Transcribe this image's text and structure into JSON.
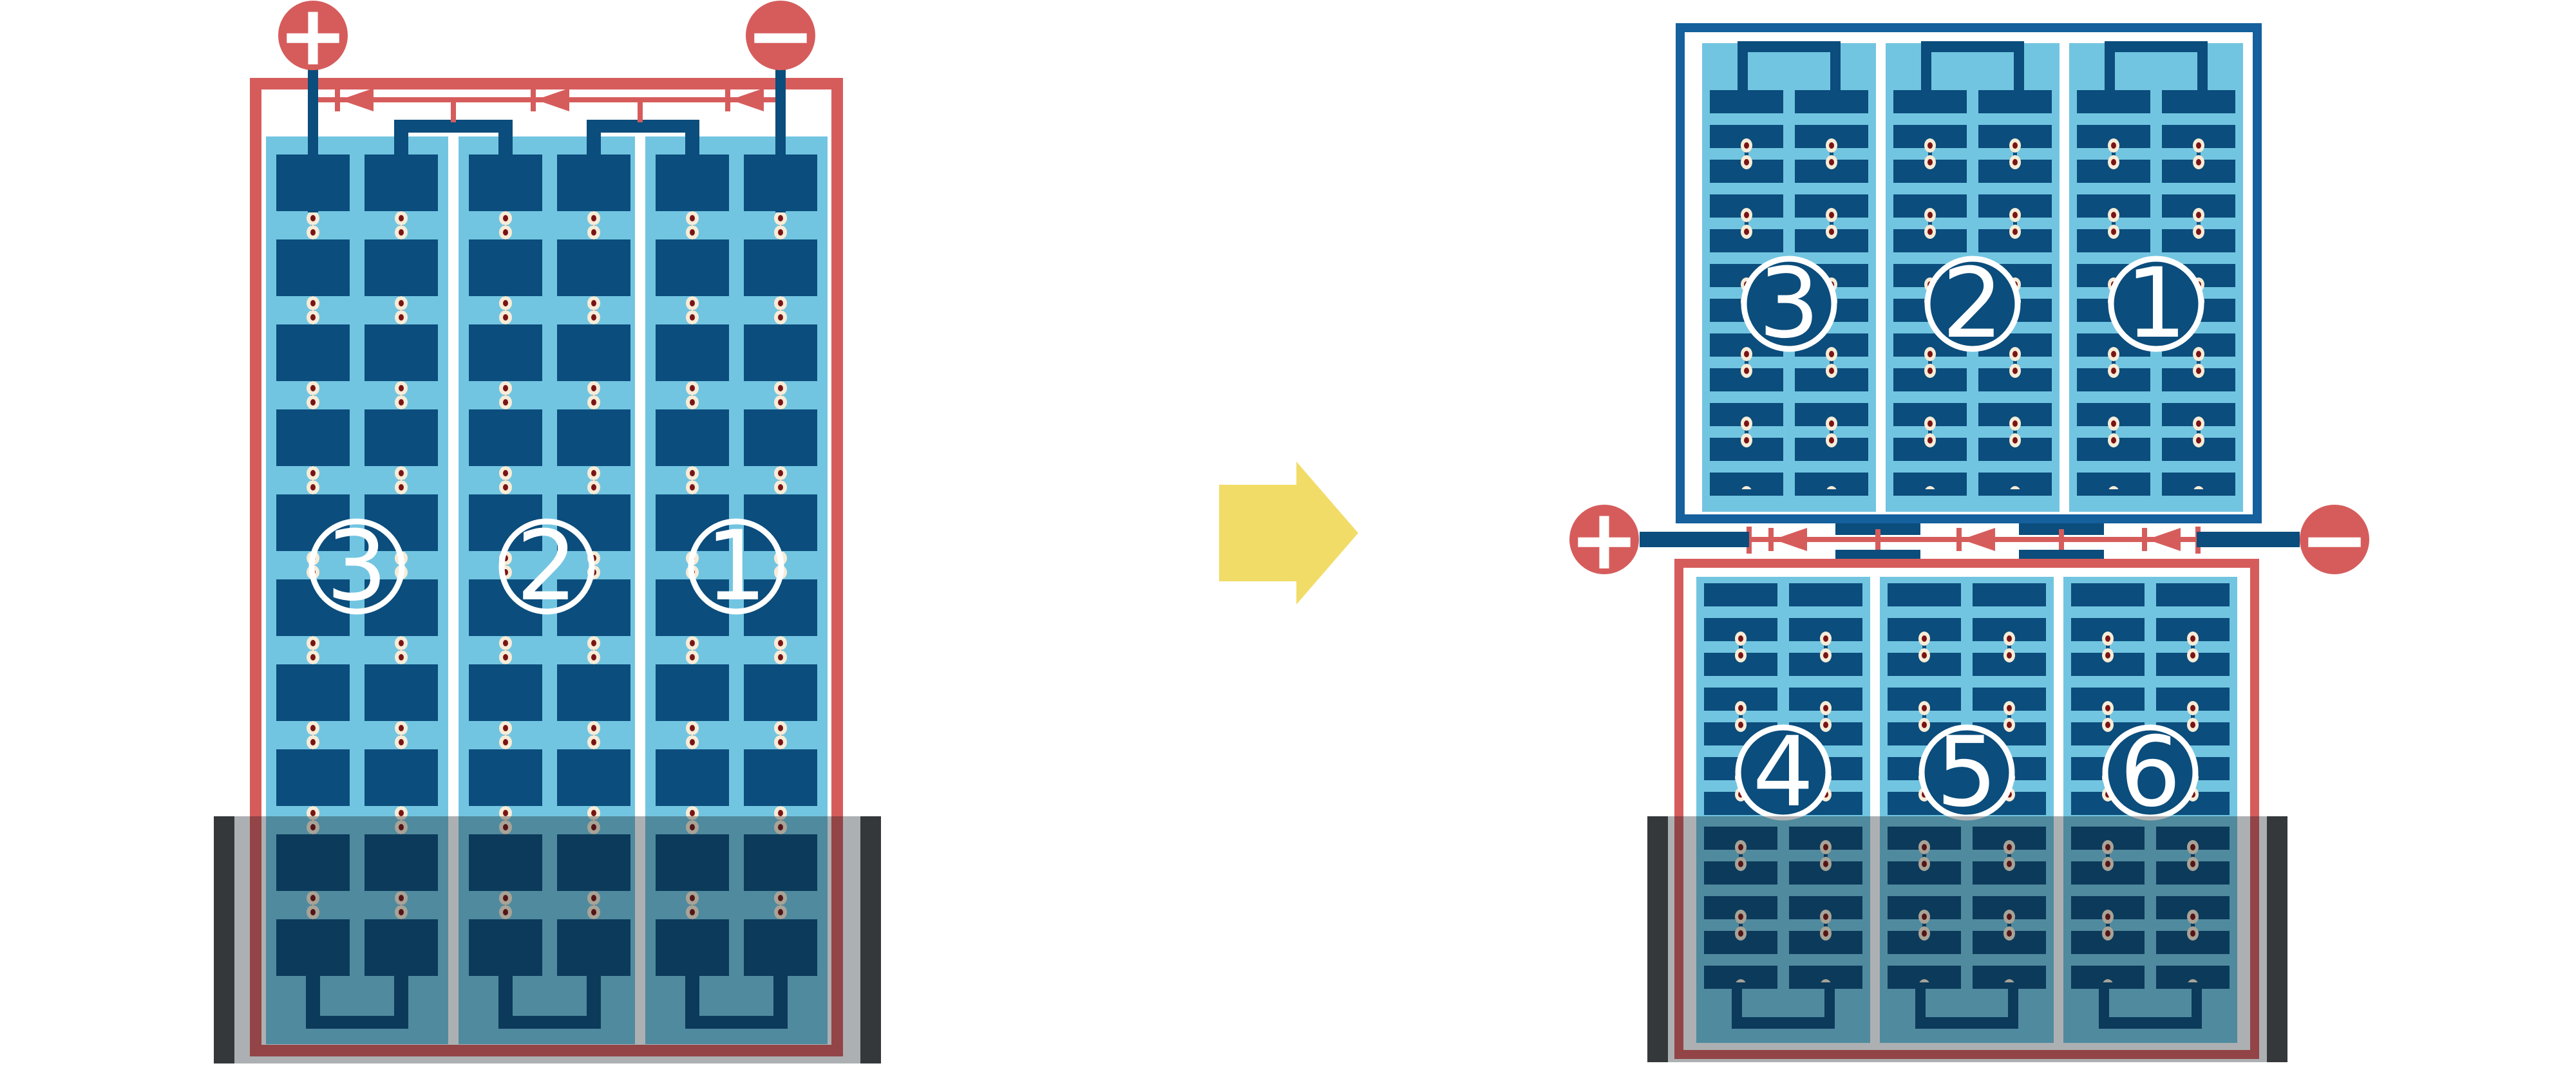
{
  "left_module": {
    "terminals": {
      "positive": "+",
      "negative": "−"
    },
    "strings": [
      {
        "label": "3"
      },
      {
        "label": "2"
      },
      {
        "label": "1"
      }
    ],
    "bypass_diode_count": 3,
    "shaded_bottom": true
  },
  "arrow": {
    "direction": "right"
  },
  "right_modules": {
    "terminals": {
      "positive": "+",
      "negative": "−"
    },
    "top_module": {
      "strings": [
        {
          "label": "3"
        },
        {
          "label": "2"
        },
        {
          "label": "1"
        }
      ]
    },
    "bottom_module": {
      "strings": [
        {
          "label": "4"
        },
        {
          "label": "5"
        },
        {
          "label": "6"
        }
      ]
    },
    "bypass_diode_count": 3,
    "shaded_bottom": true
  },
  "colors": {
    "red": "#d65c5c",
    "frame_blue": "#15609d",
    "cell_navy": "#0b4d7c",
    "light_blue": "#72c5e1",
    "solder_cream": "#f7ecd7",
    "solder_core": "#7a1414",
    "arrow_yellow": "#f2dc68",
    "shade_bar": "#4a4a4a",
    "background": "#ffffff"
  }
}
